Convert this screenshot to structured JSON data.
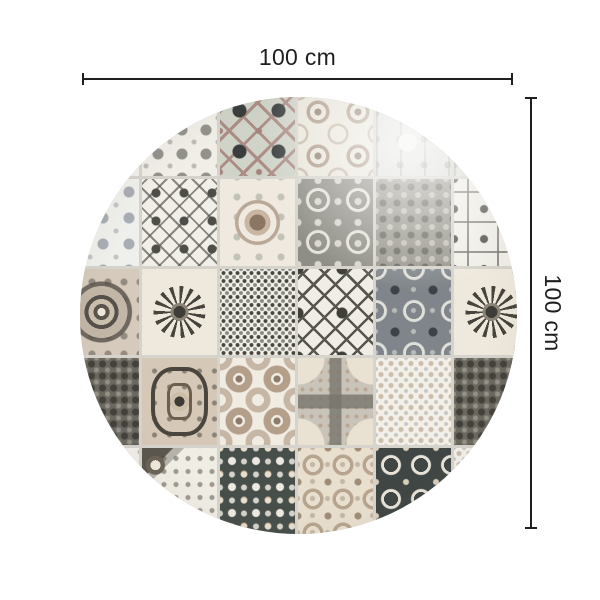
{
  "page": {
    "background": "#ffffff",
    "type": "product-dimension-diagram"
  },
  "dimensions": {
    "width": {
      "label": "100 cm"
    },
    "height": {
      "label": "100 cm"
    }
  },
  "palette": {
    "page_bg": "#ffffff",
    "ink": "#1f1f1f",
    "grout": "#d6d3cc",
    "cream": "#eeebe3",
    "light_gray": "#c9c7c0",
    "mid_gray": "#8e8d86",
    "dark_slate": "#3f4442",
    "slate_green": "#474f4b",
    "taupe": "#b3a18f",
    "rose": "#ab8d85",
    "sage": "#cfd3c8",
    "blue_gray": "#7f858a"
  },
  "rug": {
    "shape": "circle",
    "style": "patchwork-azulejo-tiles",
    "grid": [
      [
        "lace-blue",
        "lace-gray",
        "sage-floret",
        "floral-garland",
        "arch-light",
        "arch-light"
      ],
      [
        "lace-blue",
        "squares",
        "scroll-medallion",
        "floral-circles",
        "damask-dense",
        "octagon"
      ],
      [
        "medallion-dark",
        "sunflower",
        "scrollwork",
        "x-lattice",
        "ornate-squares-blue",
        "sunflower"
      ],
      [
        "botanical-dark",
        "curved-frame",
        "dot-flowers",
        "circle-cross",
        "lace-white",
        "botanical-dark"
      ],
      [
        "lace-gray",
        "corner-flower",
        "star-dark",
        "damask-cream",
        "rings-dark",
        "lace-white"
      ]
    ]
  }
}
